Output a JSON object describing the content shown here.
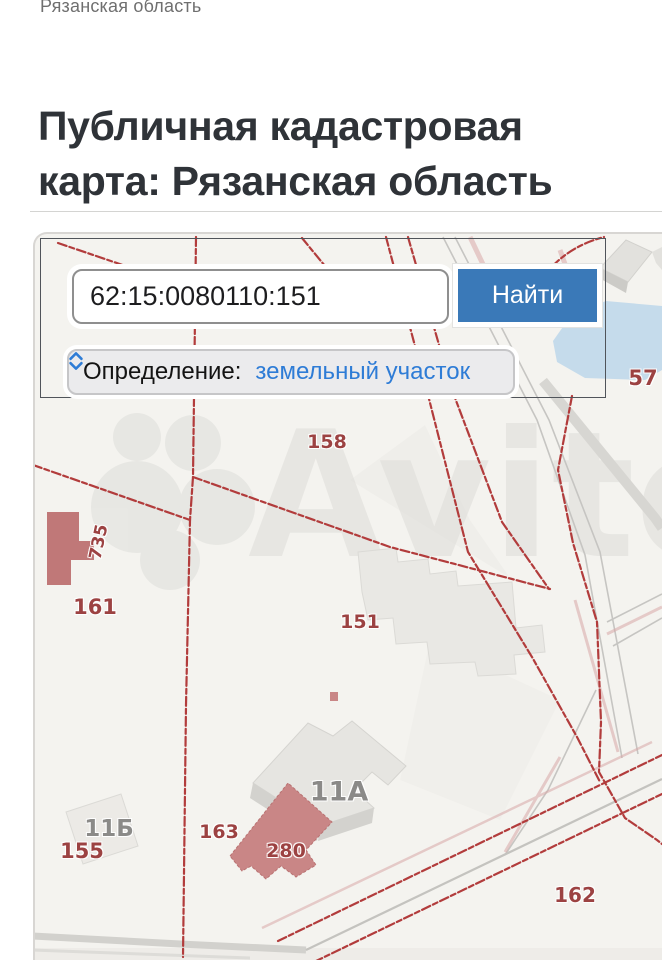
{
  "page": {
    "breadcrumb": "Рязанская область",
    "title": "Публичная кадастровая карта: Рязанская область"
  },
  "search": {
    "value": "62:15:0080110:151",
    "button_label": "Найти"
  },
  "filter": {
    "label": "Определение:",
    "value": "земельный участок"
  },
  "map": {
    "watermark": "Avito",
    "labels": {
      "p57": "57",
      "p158": "158",
      "p161": "161",
      "p151": "151",
      "p155": "155",
      "p162": "162",
      "p163": "163",
      "p280": "280",
      "p735": "735",
      "p11a": "11А",
      "p11b": "11Б"
    }
  },
  "colors": {
    "accent_blue": "#3a79b8",
    "link_blue": "#2e7cd6",
    "parcel_line_red": "#b23c3c",
    "parcel_label_red": "#9c4242",
    "water_blue": "#c5dbeb",
    "building_pink": "#c98686",
    "building_gray": "#e7e6e3",
    "map_background": "#f4f3ef"
  }
}
